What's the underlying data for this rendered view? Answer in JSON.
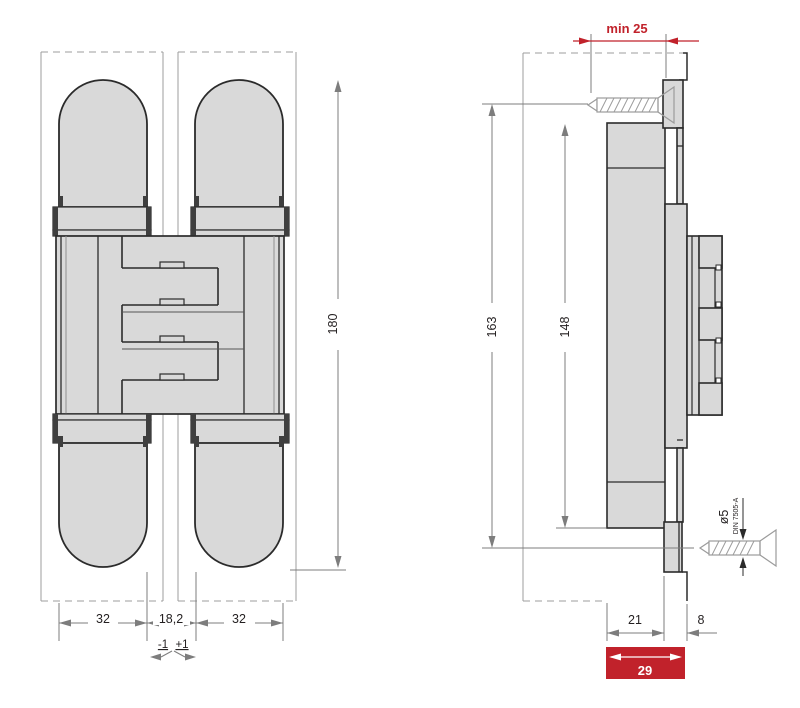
{
  "front_view": {
    "height_dim": "180",
    "leaf_width_left": "32",
    "gap_width": "18,2",
    "leaf_width_right": "32",
    "tolerance_minus": "-1",
    "tolerance_plus": "+1"
  },
  "side_view": {
    "min_inset": "min 25",
    "screw_spacing": "163",
    "body_height": "148",
    "body_depth": "21",
    "lip_depth": "8",
    "total_depth": "29",
    "screw_diameter": "ø5",
    "screw_standard": "DIN 7505-A"
  },
  "colors": {
    "highlight_red": "#c1222b",
    "part_fill": "#d9d9d9",
    "outline_dark": "#2b2b2b",
    "dimension_gray": "#7d7d7d"
  }
}
